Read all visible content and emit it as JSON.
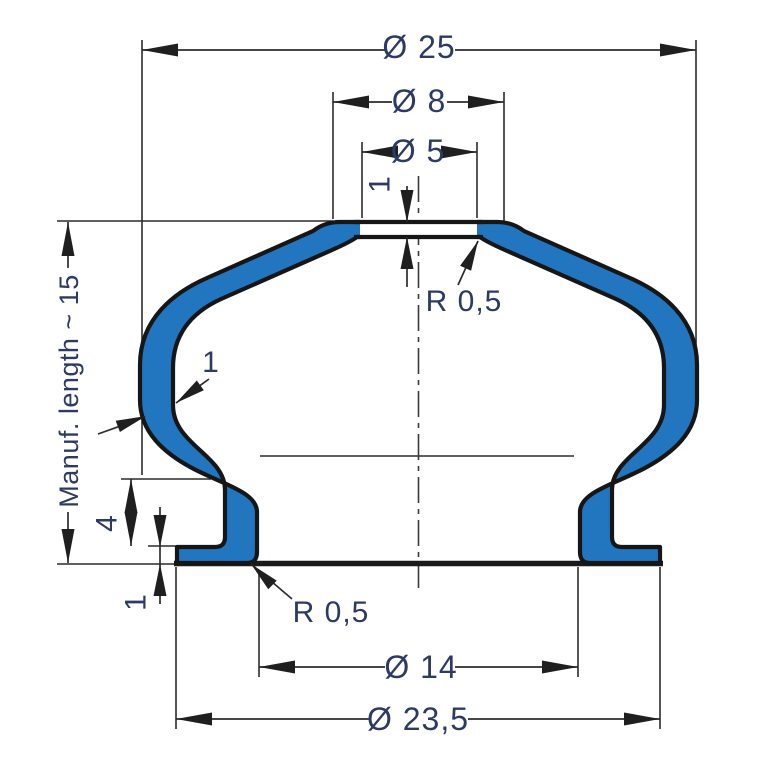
{
  "drawing": {
    "title": "bellows-cross-section",
    "labels": {
      "dia_25": "Ø 25",
      "dia_8": "Ø 8",
      "dia_5": "Ø 5",
      "membrane_thickness": "1",
      "radius_top": "R 0,5",
      "manuf_length": "Manuf. length ~ 15",
      "wall_thickness": "1",
      "step_height": "4",
      "flange_thickness": "1",
      "radius_bottom": "R 0,5",
      "dia_14": "Ø 14",
      "dia_23_5": "Ø 23,5"
    },
    "colors": {
      "profile_fill": "#2176bf",
      "profile_outline": "#161616",
      "dimension_lines": "#2c2c2c",
      "label_text": "#2c3a64",
      "background": "#ffffff"
    }
  }
}
